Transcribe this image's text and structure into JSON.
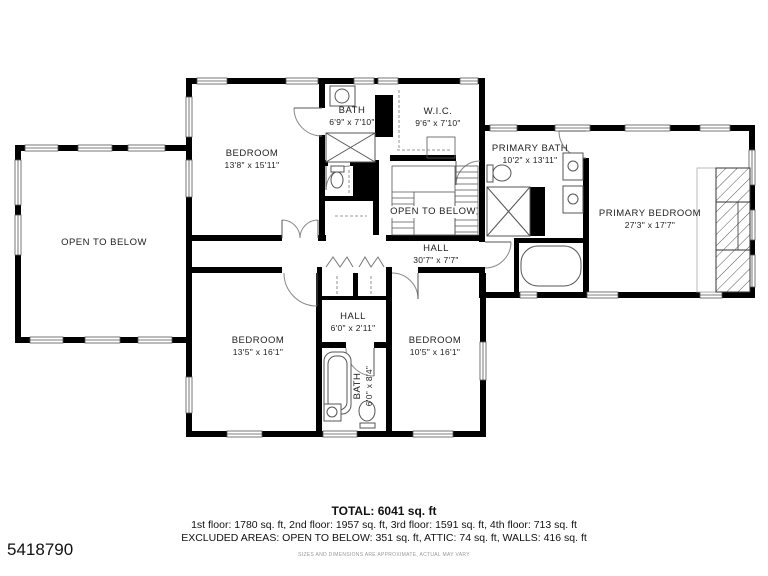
{
  "listing_id": "5418790",
  "rooms": {
    "open_below_left": {
      "name": "OPEN TO BELOW"
    },
    "bedroom_top": {
      "name": "BEDROOM",
      "dims": "13'8\" x 15'11\""
    },
    "bath_top": {
      "name": "BATH",
      "dims": "6'9\" x 7'10\""
    },
    "wic": {
      "name": "W.I.C.",
      "dims": "9'6\" x 7'10\""
    },
    "open_below_center": {
      "name": "OPEN TO BELOW"
    },
    "hall_main": {
      "name": "HALL",
      "dims": "30'7\" x 7'7\""
    },
    "primary_bath": {
      "name": "PRIMARY BATH",
      "dims": "10'2\" x 13'11\""
    },
    "primary_bedroom": {
      "name": "PRIMARY BEDROOM",
      "dims": "27'3\" x 17'7\""
    },
    "hall_small": {
      "name": "HALL",
      "dims": "6'0\" x 2'11\""
    },
    "bedroom_left": {
      "name": "BEDROOM",
      "dims": "13'5\" x 16'1\""
    },
    "bedroom_right": {
      "name": "BEDROOM",
      "dims": "10'5\" x 16'1\""
    },
    "bath_lower": {
      "name": "BATH",
      "dims": "6'0\" x 8'4\""
    }
  },
  "footer": {
    "total": "TOTAL: 6041 sq. ft",
    "floors": "1st floor: 1780 sq. ft, 2nd floor: 1957 sq. ft, 3rd floor: 1591 sq. ft, 4th floor: 713 sq. ft",
    "excluded": "EXCLUDED AREAS: OPEN TO BELOW: 351 sq. ft, ATTIC: 74 sq. ft, WALLS: 416 sq. ft",
    "disclaimer": "SIZES AND DIMENSIONS ARE APPROXIMATE, ACTUAL MAY VARY"
  },
  "colors": {
    "wall": "#000000",
    "background": "#ffffff",
    "thin_line": "#555555"
  }
}
